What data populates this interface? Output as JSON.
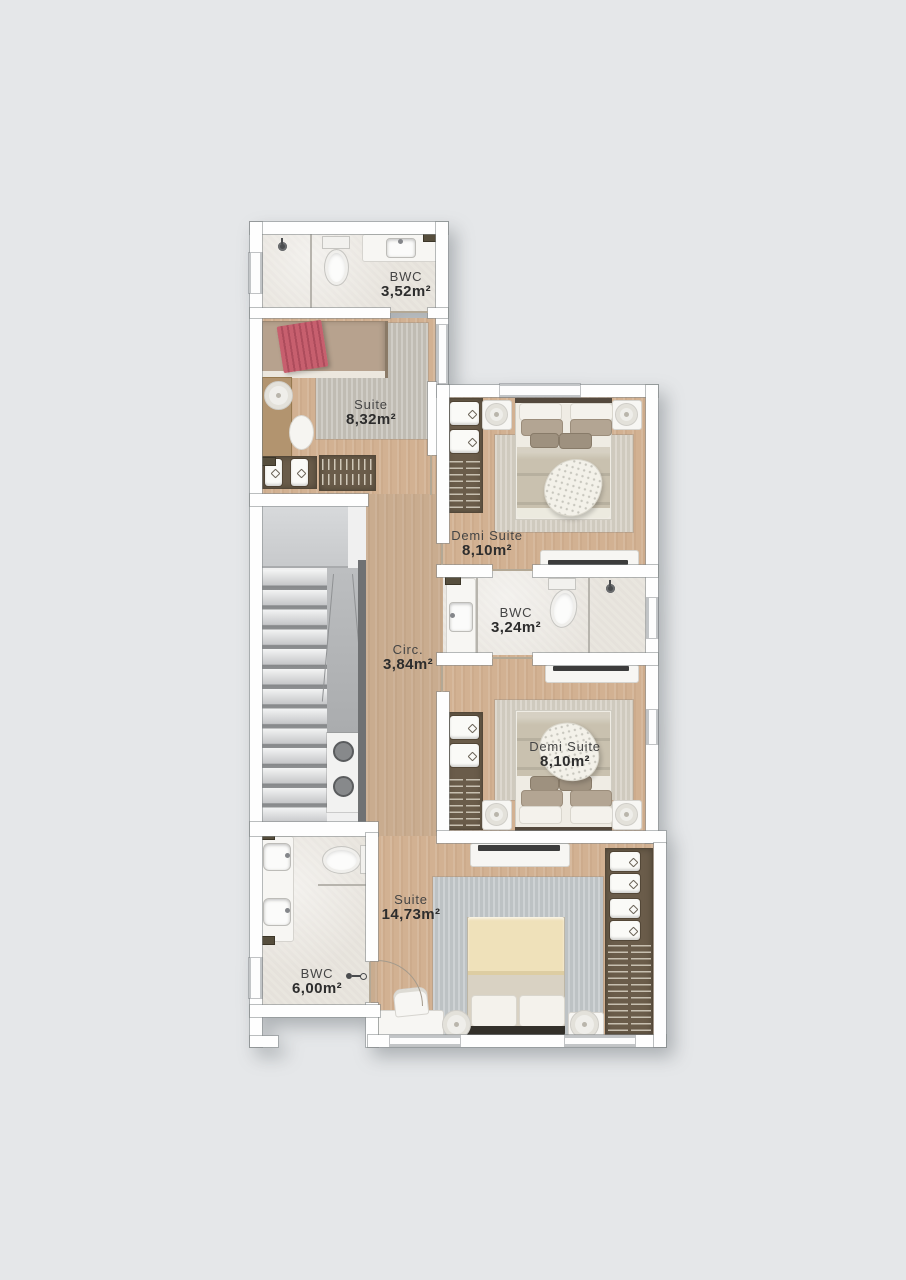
{
  "page": {
    "background": "#e5e7e9"
  },
  "plan": {
    "type": "residential-floor-plan",
    "rooms": [
      {
        "id": "bwc-top",
        "label": "BWC",
        "area": "3,52m²"
      },
      {
        "id": "suite-1",
        "label": "Suite",
        "area": "8,32m²"
      },
      {
        "id": "demi-suite-1",
        "label": "Demi Suite",
        "area": "8,10m²"
      },
      {
        "id": "circulation",
        "label": "Circ.",
        "area": "3,84m²"
      },
      {
        "id": "bwc-middle",
        "label": "BWC",
        "area": "3,24m²"
      },
      {
        "id": "demi-suite-2",
        "label": "Demi Suite",
        "area": "8,10m²"
      },
      {
        "id": "suite-2",
        "label": "Suite",
        "area": "14,73m²"
      },
      {
        "id": "bwc-bottom",
        "label": "BWC",
        "area": "6,00m²"
      }
    ],
    "colors": {
      "background": "#e5e7e9",
      "wall": "#fefefe",
      "wall_outline": "#84888b",
      "wood_floor": "#d2b192",
      "corridor_floor": "#c9ac8f",
      "tile_floor": "#e9e5de",
      "rug": "#ccc8c0",
      "rug_cool": "#c3c8ca",
      "wardrobe": "#6a5c4a",
      "bed_blanket": "#c9c1af",
      "bed_mattress": "#b7a28e",
      "throw_pink": "#c75f6e",
      "blanket_cream": "#efe1ba",
      "stair_panel": "#b3b5b7",
      "stair_rail": "#6f7173",
      "label_text": "#2d2d2d"
    }
  }
}
